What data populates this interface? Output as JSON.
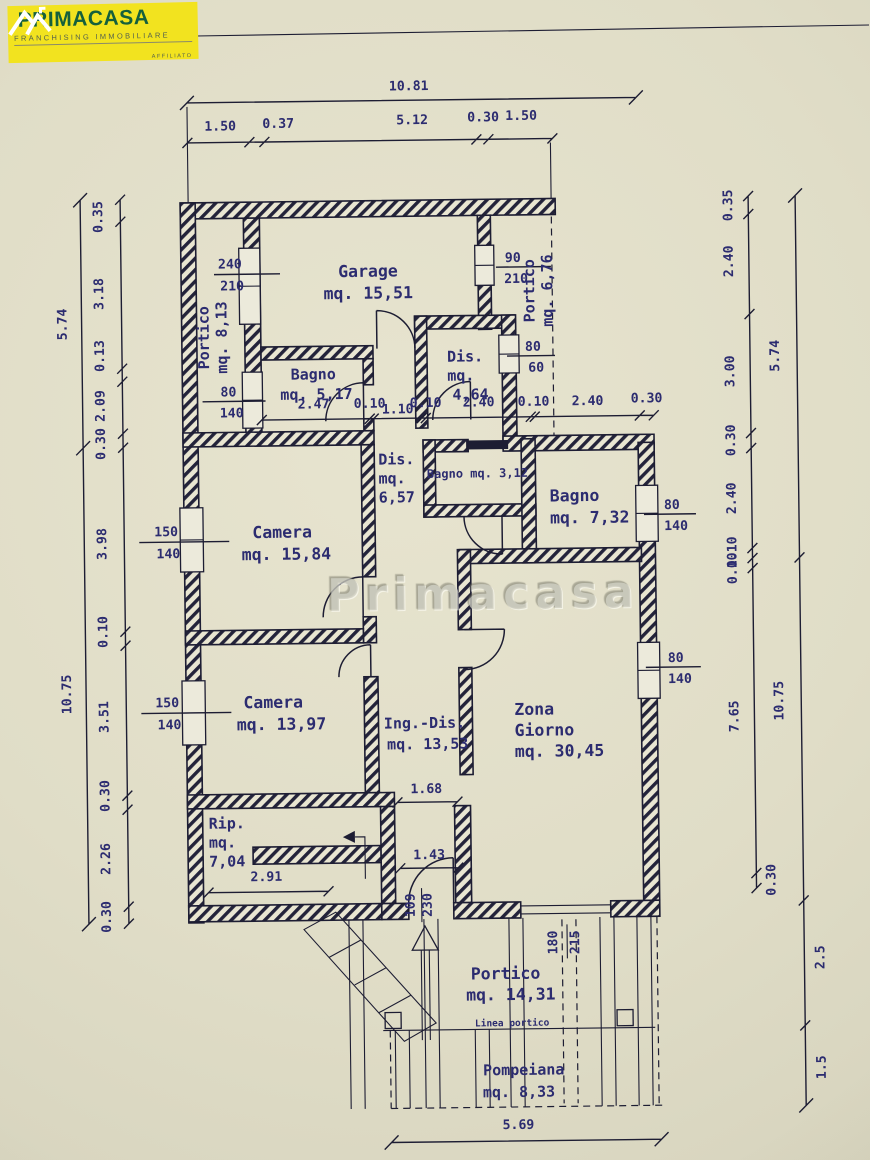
{
  "logo": {
    "brand": "PRIMACASA",
    "tagline": "FRANCHISING IMMOBILIARE",
    "affiliate": "AFFILIATO"
  },
  "watermark": "Primacasa",
  "colors": {
    "paper": "#e0ddc7",
    "ink": "#1d1d33",
    "label": "#2c2c70",
    "logo_yellow": "#f2e31f",
    "logo_green": "#15603c"
  },
  "rooms": {
    "garage": {
      "name": "Garage",
      "area": "mq. 15,51"
    },
    "portico_left": {
      "name": "Portico",
      "area": "mq. 8,13"
    },
    "portico_right": {
      "name": "Portico",
      "area": "mq. 6,76"
    },
    "bagno_1": {
      "name": "Bagno",
      "area": "mq. 5,17"
    },
    "dis_1": {
      "name": "Dis.",
      "mq": "mq.",
      "area": "4,64"
    },
    "dis_2": {
      "name": "Dis.",
      "mq": "mq.",
      "area": "6,57"
    },
    "bagno_2": {
      "label": "Bagno mq. 3,12"
    },
    "bagno_3": {
      "name": "Bagno",
      "area": "mq. 7,32"
    },
    "camera_1": {
      "name": "Camera",
      "area": "mq. 15,84"
    },
    "camera_2": {
      "name": "Camera",
      "area": "mq. 13,97"
    },
    "ing_dis": {
      "name": "Ing.-Dis.",
      "area": "mq. 13,53"
    },
    "zona_giorno": {
      "line1": "Zona",
      "line2": "Giorno",
      "area": "mq. 30,45"
    },
    "rip": {
      "name": "Rip.",
      "mq": "mq.",
      "area": "7,04"
    },
    "portico_bottom": {
      "name": "Portico",
      "area": "mq. 14,31"
    },
    "linea_portico": "Linea portico",
    "pompeiana": {
      "name": "Pompeiana",
      "area": "mq. 8,33"
    }
  },
  "dimensions": {
    "top_total": "10.81",
    "top_segments": [
      "1.50",
      "0.37",
      "5.12",
      "0.30",
      "1.50"
    ],
    "left_upper_total": "5.74",
    "left_upper_segments": [
      "0.35",
      "3.18",
      "0.13",
      "2.09",
      "0.30"
    ],
    "left_lower_total": "10.75",
    "left_lower_segments": [
      "3.98",
      "0.10",
      "3.51",
      "0.30",
      "2.26",
      "0.30"
    ],
    "right_upper_total": "5.74",
    "right_upper_segments": [
      "0.35",
      "2.40",
      "3.00",
      "0.30",
      "2.40",
      "0.10"
    ],
    "right_lower_total": "10.75",
    "right_lower_segments": [
      "0.10",
      "7.65",
      "0.30",
      "2.5",
      "1.5"
    ],
    "bottom_total": "5.69",
    "interior_row": [
      "2.47",
      "0.10",
      "1.10",
      "0.10",
      "2.40",
      "0.10",
      "2.40",
      "0.30"
    ],
    "rip_width": "2.91",
    "hall_width": "1.68",
    "entry_width": "1.43"
  },
  "openings": {
    "win_240_210": [
      "240",
      "210"
    ],
    "win_90_210": [
      "90",
      "210"
    ],
    "win_80_60": [
      "80",
      "60"
    ],
    "win_80_140_a": [
      "80",
      "140"
    ],
    "win_80_140_b": [
      "80",
      "140"
    ],
    "win_80_140_c": [
      "80",
      "140"
    ],
    "win_150_140_a": [
      "150",
      "140"
    ],
    "win_150_140_b": [
      "150",
      "140"
    ],
    "door_109_230": [
      "109",
      "230"
    ],
    "door_180_215": [
      "180",
      "215"
    ]
  }
}
